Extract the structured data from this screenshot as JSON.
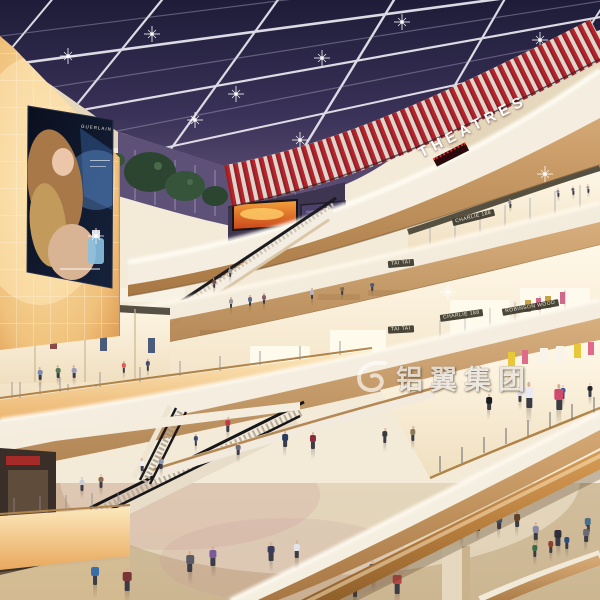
{
  "scene": {
    "type": "architectural-rendering",
    "subject": "Multi-level shopping mall atrium interior at dusk with skylight ceiling, curved balconies, escalators and shoppers",
    "signs": {
      "theatre": "THEATRES",
      "ad_brand": "GUERLAIN",
      "store_taitai_upper": "TAI TAI",
      "store_taitai_lower": "TAI TAI",
      "store_charlie_upper": "CHARLIE 188",
      "store_charlie_lower": "CHARLIE 188",
      "store_robinson": "ROBINSON WOOD"
    },
    "watermark": {
      "text": "铝翼集团"
    },
    "colors": {
      "skylight_night": "#2d2a4e",
      "skylight_beam": "#eceaf2",
      "theatre_red": "#b3242c",
      "wood_trim": "#c49864",
      "fascia_cream": "#f2ebdc",
      "cove_glow": "#f7cc8a",
      "floor_marble": "#d8c6a6",
      "storefront_warm": "#fdf4e0",
      "glass_dusk_purple": "#5d5178",
      "tree_foliage": "#2c4531",
      "led_fire_orange": "#e8651c",
      "billboard_navy": "#0d1322",
      "handrail_wood": "#b97f3e"
    }
  },
  "people": [
    [
      95,
      585,
      22,
      "#3a6ea8"
    ],
    [
      127,
      591,
      24,
      "#7a3636"
    ],
    [
      190,
      572,
      21,
      "#5a5a66"
    ],
    [
      213,
      566,
      20,
      "#7a5a9a"
    ],
    [
      271,
      561,
      19,
      "#3a3a5a"
    ],
    [
      297,
      558,
      18,
      "#e4e4e8"
    ],
    [
      355,
      597,
      22,
      "#3a9aa0"
    ],
    [
      397,
      594,
      24,
      "#b84848"
    ],
    [
      373,
      580,
      20,
      "#284878"
    ],
    [
      536,
      540,
      18,
      "#8a8aa4"
    ],
    [
      558,
      546,
      20,
      "#303038"
    ],
    [
      588,
      532,
      18,
      "#48708c"
    ],
    [
      462,
      536,
      16,
      "#4a6a3c"
    ],
    [
      478,
      531,
      16,
      "#2e2e34"
    ],
    [
      499,
      529,
      16,
      "#3a5a8c"
    ],
    [
      517,
      527,
      16,
      "#6e4a2c"
    ],
    [
      82,
      491,
      14,
      "#c8ccd8"
    ],
    [
      101,
      488,
      14,
      "#8a6a4a"
    ],
    [
      142,
      471,
      13,
      "#f0f0f4"
    ],
    [
      161,
      469,
      13,
      "#8898b0"
    ],
    [
      238,
      455,
      13,
      "#686a78"
    ],
    [
      40,
      380,
      13,
      "#7a8ab2"
    ],
    [
      58,
      378,
      13,
      "#567a58"
    ],
    [
      74,
      378,
      13,
      "#9a9aba"
    ],
    [
      124,
      373,
      12,
      "#e05a5c"
    ],
    [
      148,
      371,
      12,
      "#4a4a6c"
    ],
    [
      231,
      308,
      11,
      "#98989e"
    ],
    [
      250,
      306,
      11,
      "#5a6a8c"
    ],
    [
      264,
      304,
      11,
      "#8a5a6a"
    ],
    [
      312,
      299,
      11,
      "#b5b5c5"
    ],
    [
      342,
      295,
      10,
      "#7a6a5c"
    ],
    [
      372,
      291,
      10,
      "#4a5a7c"
    ],
    [
      510,
      208,
      9,
      "#7a8a9a"
    ],
    [
      558,
      197,
      9,
      "#8a8a9c"
    ],
    [
      573,
      195,
      9,
      "#5a5a68"
    ],
    [
      588,
      193,
      9,
      "#aa9aa0"
    ],
    [
      285,
      447,
      16,
      "#2a3a5c"
    ],
    [
      313,
      449,
      17,
      "#8a2a3c"
    ],
    [
      385,
      443,
      15,
      "#3c3c40"
    ],
    [
      413,
      441,
      15,
      "#8a7a5c"
    ],
    [
      489,
      410,
      16,
      "#1c1c20"
    ],
    [
      520,
      402,
      14,
      "#d8d8e8"
    ],
    [
      563,
      399,
      14,
      "#3a5aa2"
    ],
    [
      590,
      397,
      14,
      "#26262c"
    ],
    [
      529,
      408,
      26,
      "#eaeaf2"
    ],
    [
      559,
      410,
      26,
      "#d04a6e"
    ],
    [
      535,
      557,
      15,
      "#3a6a4a"
    ],
    [
      551,
      553,
      15,
      "#88442c"
    ],
    [
      567,
      549,
      15,
      "#2c4c7c"
    ],
    [
      586,
      542,
      16,
      "#6a6a74"
    ],
    [
      228,
      432,
      15,
      "#c03a4c"
    ],
    [
      196,
      446,
      12,
      "#3a4a6c"
    ],
    [
      214,
      288,
      10,
      "#7a4a4c"
    ],
    [
      230,
      277,
      10,
      "#98989e"
    ]
  ]
}
